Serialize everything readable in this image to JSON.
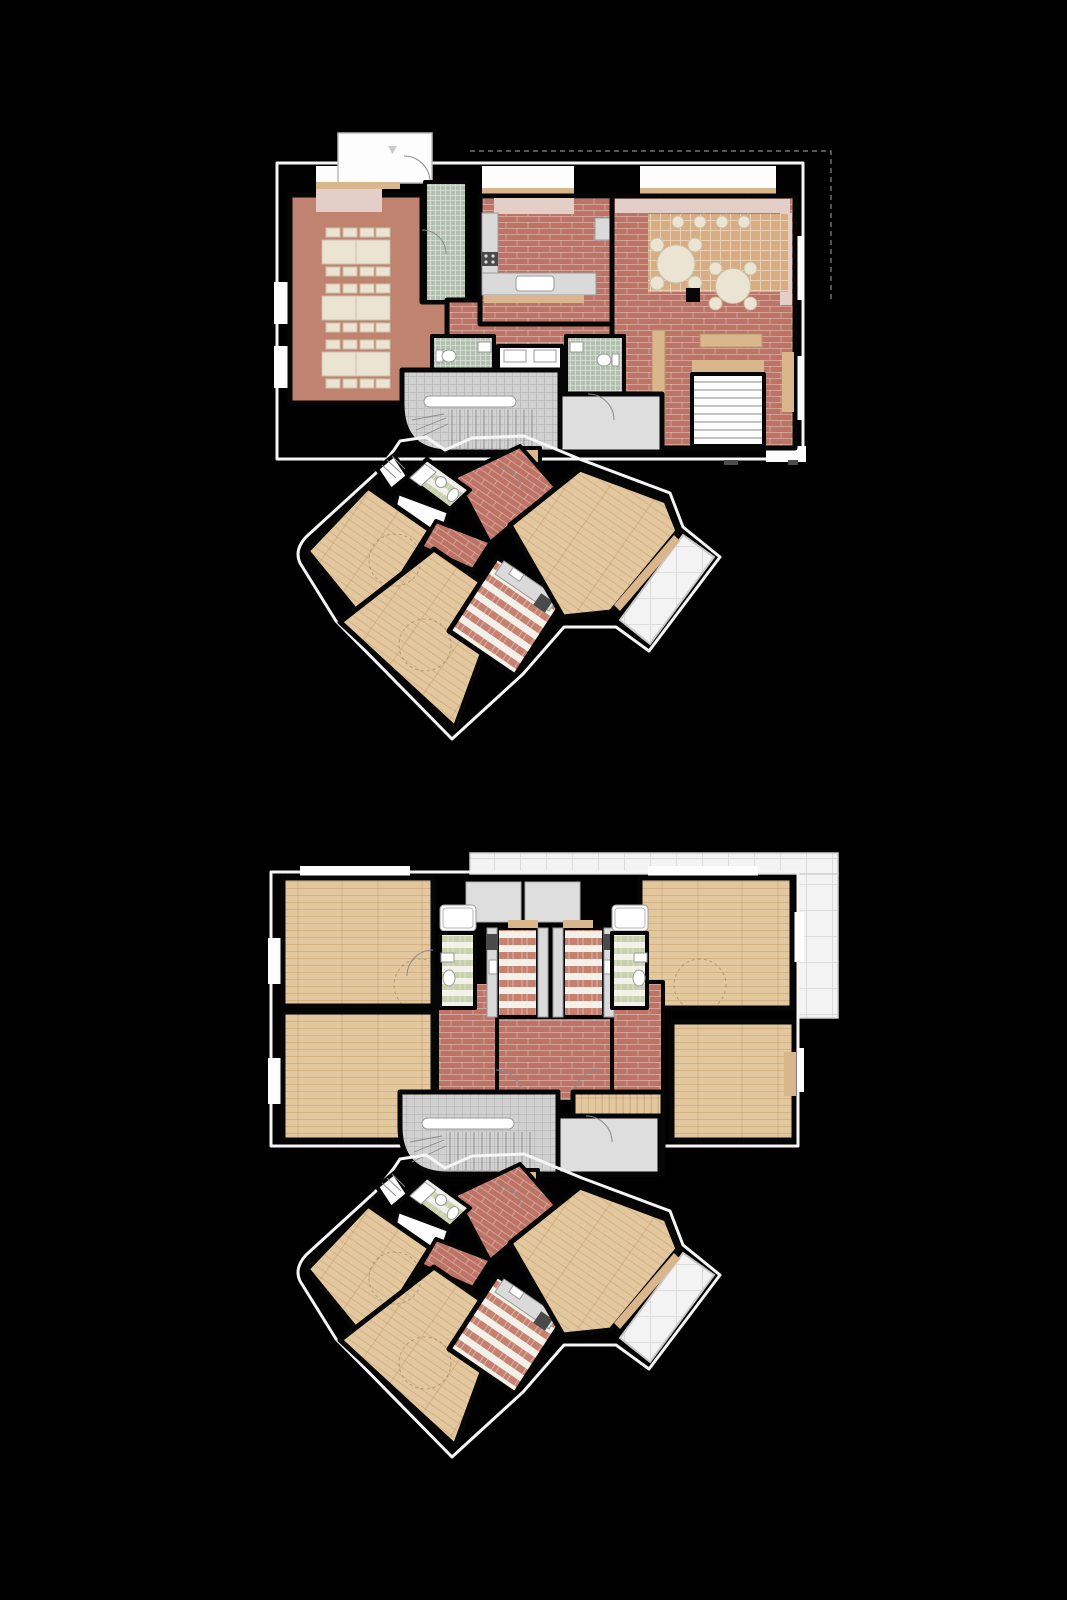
{
  "canvas": {
    "width": 1067,
    "height": 1600,
    "background": "#000000"
  },
  "palette": {
    "background": "#000000",
    "walls": "#060606",
    "outline": "#f5f5f5",
    "salmon": "#c08370",
    "brick": "#bd7365",
    "brick_mortar": "#ecd2c7",
    "wood": "#e3c79e",
    "wood_grain": "#a8793f",
    "wood_accent": "#d9b68c",
    "parquet": "#d9ad82",
    "parquet_line": "#f6ece2",
    "green_tile": "#b2c1af",
    "green_stripe": "#c8d0ac",
    "stripe_bg": "#f1f0e9",
    "red_stripe": "#c6806f",
    "gray_tile": "#d1d1d1",
    "gray_line": "#6e6e6e",
    "landing": "#dedede",
    "terrace": "#f3f3f3",
    "terrace_line": "#dcdcdc",
    "counter": "#dadada",
    "counter_stroke": "#9a9a9a",
    "furniture": "#ece4d3",
    "furniture_stroke": "#cbbfa8",
    "pink_bench": "#e4cfc8",
    "white_floor": "#fdfdfd",
    "stove": "#4a4a4a",
    "door_arc": "#8a8a8a"
  },
  "drawing": {
    "label": "Two stacked apartment floor plans on black background",
    "wing_rotation_deg": 34.5
  },
  "plans": [
    {
      "id": "ground-floor-plan",
      "label": "Lower floor plan with communal dining room, kitchen and lounge",
      "rooms": [
        {
          "name": "entry-vestibule",
          "floor": "white"
        },
        {
          "name": "dining-room",
          "floor": "salmon",
          "furniture": "three long tables with eight chairs each"
        },
        {
          "name": "entry-corridor",
          "floor": "green-tile"
        },
        {
          "name": "kitchen",
          "floor": "brick",
          "furniture": "counters, stove, sink island"
        },
        {
          "name": "hallway",
          "floor": "brick"
        },
        {
          "name": "lounge",
          "floor": "brick-and-parquet",
          "furniture": "two round tables, stools, benches, staircase"
        },
        {
          "name": "bathroom-left",
          "floor": "green-tile"
        },
        {
          "name": "washroom",
          "floor": "white",
          "furniture": "two sinks"
        },
        {
          "name": "bathroom-right",
          "floor": "green-tile"
        },
        {
          "name": "stairwell",
          "floor": "gray-tile"
        }
      ]
    },
    {
      "id": "upper-floor-plan",
      "label": "Upper floor plan with four bedrooms and two mirrored kitchens",
      "rooms": [
        {
          "name": "bedroom-top-left",
          "floor": "wood"
        },
        {
          "name": "bedroom-bottom-left",
          "floor": "wood"
        },
        {
          "name": "bedroom-top-right",
          "floor": "wood"
        },
        {
          "name": "bedroom-mid-right",
          "floor": "wood"
        },
        {
          "name": "bedroom-small-center",
          "floor": "wood"
        },
        {
          "name": "kitchen-left",
          "floor": "red-stripe"
        },
        {
          "name": "kitchen-right",
          "floor": "red-stripe"
        },
        {
          "name": "bathroom-left",
          "floor": "green-stripe",
          "furniture": "bathtub, sink, toilet"
        },
        {
          "name": "bathroom-right",
          "floor": "green-stripe",
          "furniture": "bathtub, sink, toilet"
        },
        {
          "name": "hallway",
          "floor": "brick"
        },
        {
          "name": "stairwell",
          "floor": "gray-tile"
        },
        {
          "name": "roof-terrace",
          "floor": "terrace-grid"
        }
      ]
    }
  ],
  "wing": {
    "label": "Angled bedroom wing (repeated on both floors)",
    "rooms": [
      {
        "name": "wing-steps",
        "floor": "white"
      },
      {
        "name": "wing-bathroom",
        "floor": "green-stripe",
        "furniture": "bathtub, sink, toilet"
      },
      {
        "name": "wing-hall",
        "floor": "brick"
      },
      {
        "name": "wing-bedroom-1",
        "floor": "wood"
      },
      {
        "name": "wing-bedroom-2",
        "floor": "wood"
      },
      {
        "name": "wing-kitchen",
        "floor": "red-stripe",
        "furniture": "counter, stove, sink"
      },
      {
        "name": "wing-bedroom-3",
        "floor": "wood",
        "furniture": "bench"
      },
      {
        "name": "wing-terrace",
        "floor": "terrace"
      }
    ]
  }
}
